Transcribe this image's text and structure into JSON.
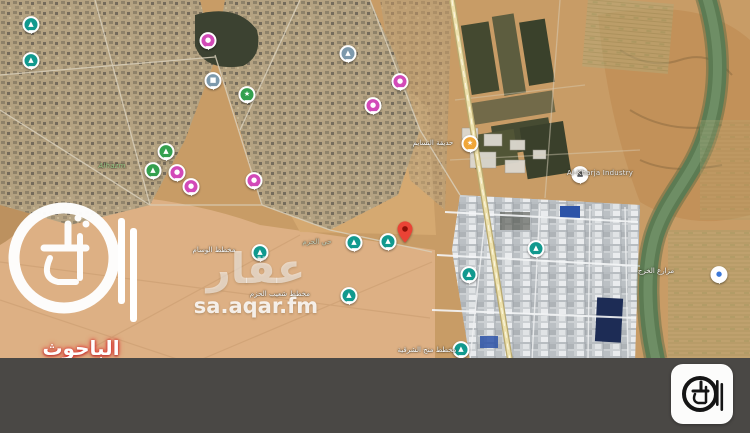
{
  "branding": {
    "agency_name": "الباحوث العقارية",
    "watermark_title": "عقار",
    "watermark_url": "sa.aqar.fm"
  },
  "map": {
    "property_pin": {
      "x": 405,
      "y": 243,
      "color": "#ea4335"
    },
    "marker_colors": {
      "mosque_teal": "#11998e",
      "park_green": "#34a04f",
      "service_pink": "#d24ab8",
      "civic_slate": "#7d99ac",
      "garden_orange": "#f0a638",
      "poi_white": "#ffffff"
    },
    "markers": [
      {
        "x": 31,
        "y": 26,
        "color": "#11998e",
        "glyph": "▲",
        "type": "mosque"
      },
      {
        "x": 31,
        "y": 62,
        "color": "#11998e",
        "glyph": "▲",
        "type": "mosque"
      },
      {
        "x": 208,
        "y": 42,
        "color": "#d24ab8",
        "glyph": "●",
        "type": "service"
      },
      {
        "x": 213,
        "y": 82,
        "color": "#7d99ac",
        "glyph": "■",
        "type": "civic"
      },
      {
        "x": 247,
        "y": 96,
        "color": "#34a04f",
        "glyph": "★",
        "type": "park"
      },
      {
        "x": 166,
        "y": 153,
        "color": "#34a04f",
        "glyph": "▲",
        "type": "park"
      },
      {
        "x": 153,
        "y": 172,
        "color": "#34a04f",
        "glyph": "▲",
        "type": "park"
      },
      {
        "x": 177,
        "y": 174,
        "color": "#d24ab8",
        "glyph": "●",
        "type": "service"
      },
      {
        "x": 191,
        "y": 188,
        "color": "#d24ab8",
        "glyph": "●",
        "type": "service"
      },
      {
        "x": 254,
        "y": 182,
        "color": "#d24ab8",
        "glyph": "●",
        "type": "service"
      },
      {
        "x": 348,
        "y": 55,
        "color": "#7d99ac",
        "glyph": "▲",
        "type": "civic"
      },
      {
        "x": 400,
        "y": 83,
        "color": "#d24ab8",
        "glyph": "●",
        "type": "service"
      },
      {
        "x": 373,
        "y": 107,
        "color": "#d24ab8",
        "glyph": "●",
        "type": "service"
      },
      {
        "x": 470,
        "y": 145,
        "color": "#f0a638",
        "glyph": "★",
        "type": "garden"
      },
      {
        "x": 580,
        "y": 176,
        "color": "#ffffff",
        "glyph": "■",
        "glyph_color": "#5b5f66",
        "type": "industry"
      },
      {
        "x": 354,
        "y": 244,
        "color": "#11998e",
        "glyph": "▲",
        "type": "mosque"
      },
      {
        "x": 388,
        "y": 243,
        "color": "#11998e",
        "glyph": "▲",
        "type": "mosque"
      },
      {
        "x": 260,
        "y": 254,
        "color": "#11998e",
        "glyph": "▲",
        "type": "mosque"
      },
      {
        "x": 349,
        "y": 297,
        "color": "#11998e",
        "glyph": "▲",
        "type": "mosque"
      },
      {
        "x": 536,
        "y": 250,
        "color": "#11998e",
        "glyph": "▲",
        "type": "mosque"
      },
      {
        "x": 469,
        "y": 276,
        "color": "#11998e",
        "glyph": "▲",
        "type": "mosque"
      },
      {
        "x": 461,
        "y": 351,
        "color": "#11998e",
        "glyph": "▲",
        "type": "mosque"
      },
      {
        "x": 719,
        "y": 276,
        "color": "#ffffff",
        "glyph": "●",
        "glyph_color": "#3c78d8",
        "type": "poi"
      }
    ],
    "labels": [
      {
        "text": "Alhazm",
        "x": 112,
        "y": 166,
        "color": "#9fcf8e",
        "italic": true
      },
      {
        "text": "حي الحزم",
        "x": 317,
        "y": 242,
        "color": "#cfd8c2"
      },
      {
        "text": "مخطط الوسام",
        "x": 214,
        "y": 250,
        "color": "#ffffff"
      },
      {
        "text": "مخطط شعيب الحزم",
        "x": 280,
        "y": 294,
        "color": "#ffffff"
      },
      {
        "text": "Al-Kharja Industry",
        "x": 600,
        "y": 173,
        "color": "#f4f4f4"
      },
      {
        "text": "حديقة النسايم",
        "x": 433,
        "y": 143,
        "color": "#ffffff"
      },
      {
        "text": "مخطط منح الشرقية",
        "x": 427,
        "y": 350,
        "color": "#ffffff"
      },
      {
        "text": "مزارع الخرج",
        "x": 656,
        "y": 271,
        "color": "#ffffff"
      }
    ]
  }
}
